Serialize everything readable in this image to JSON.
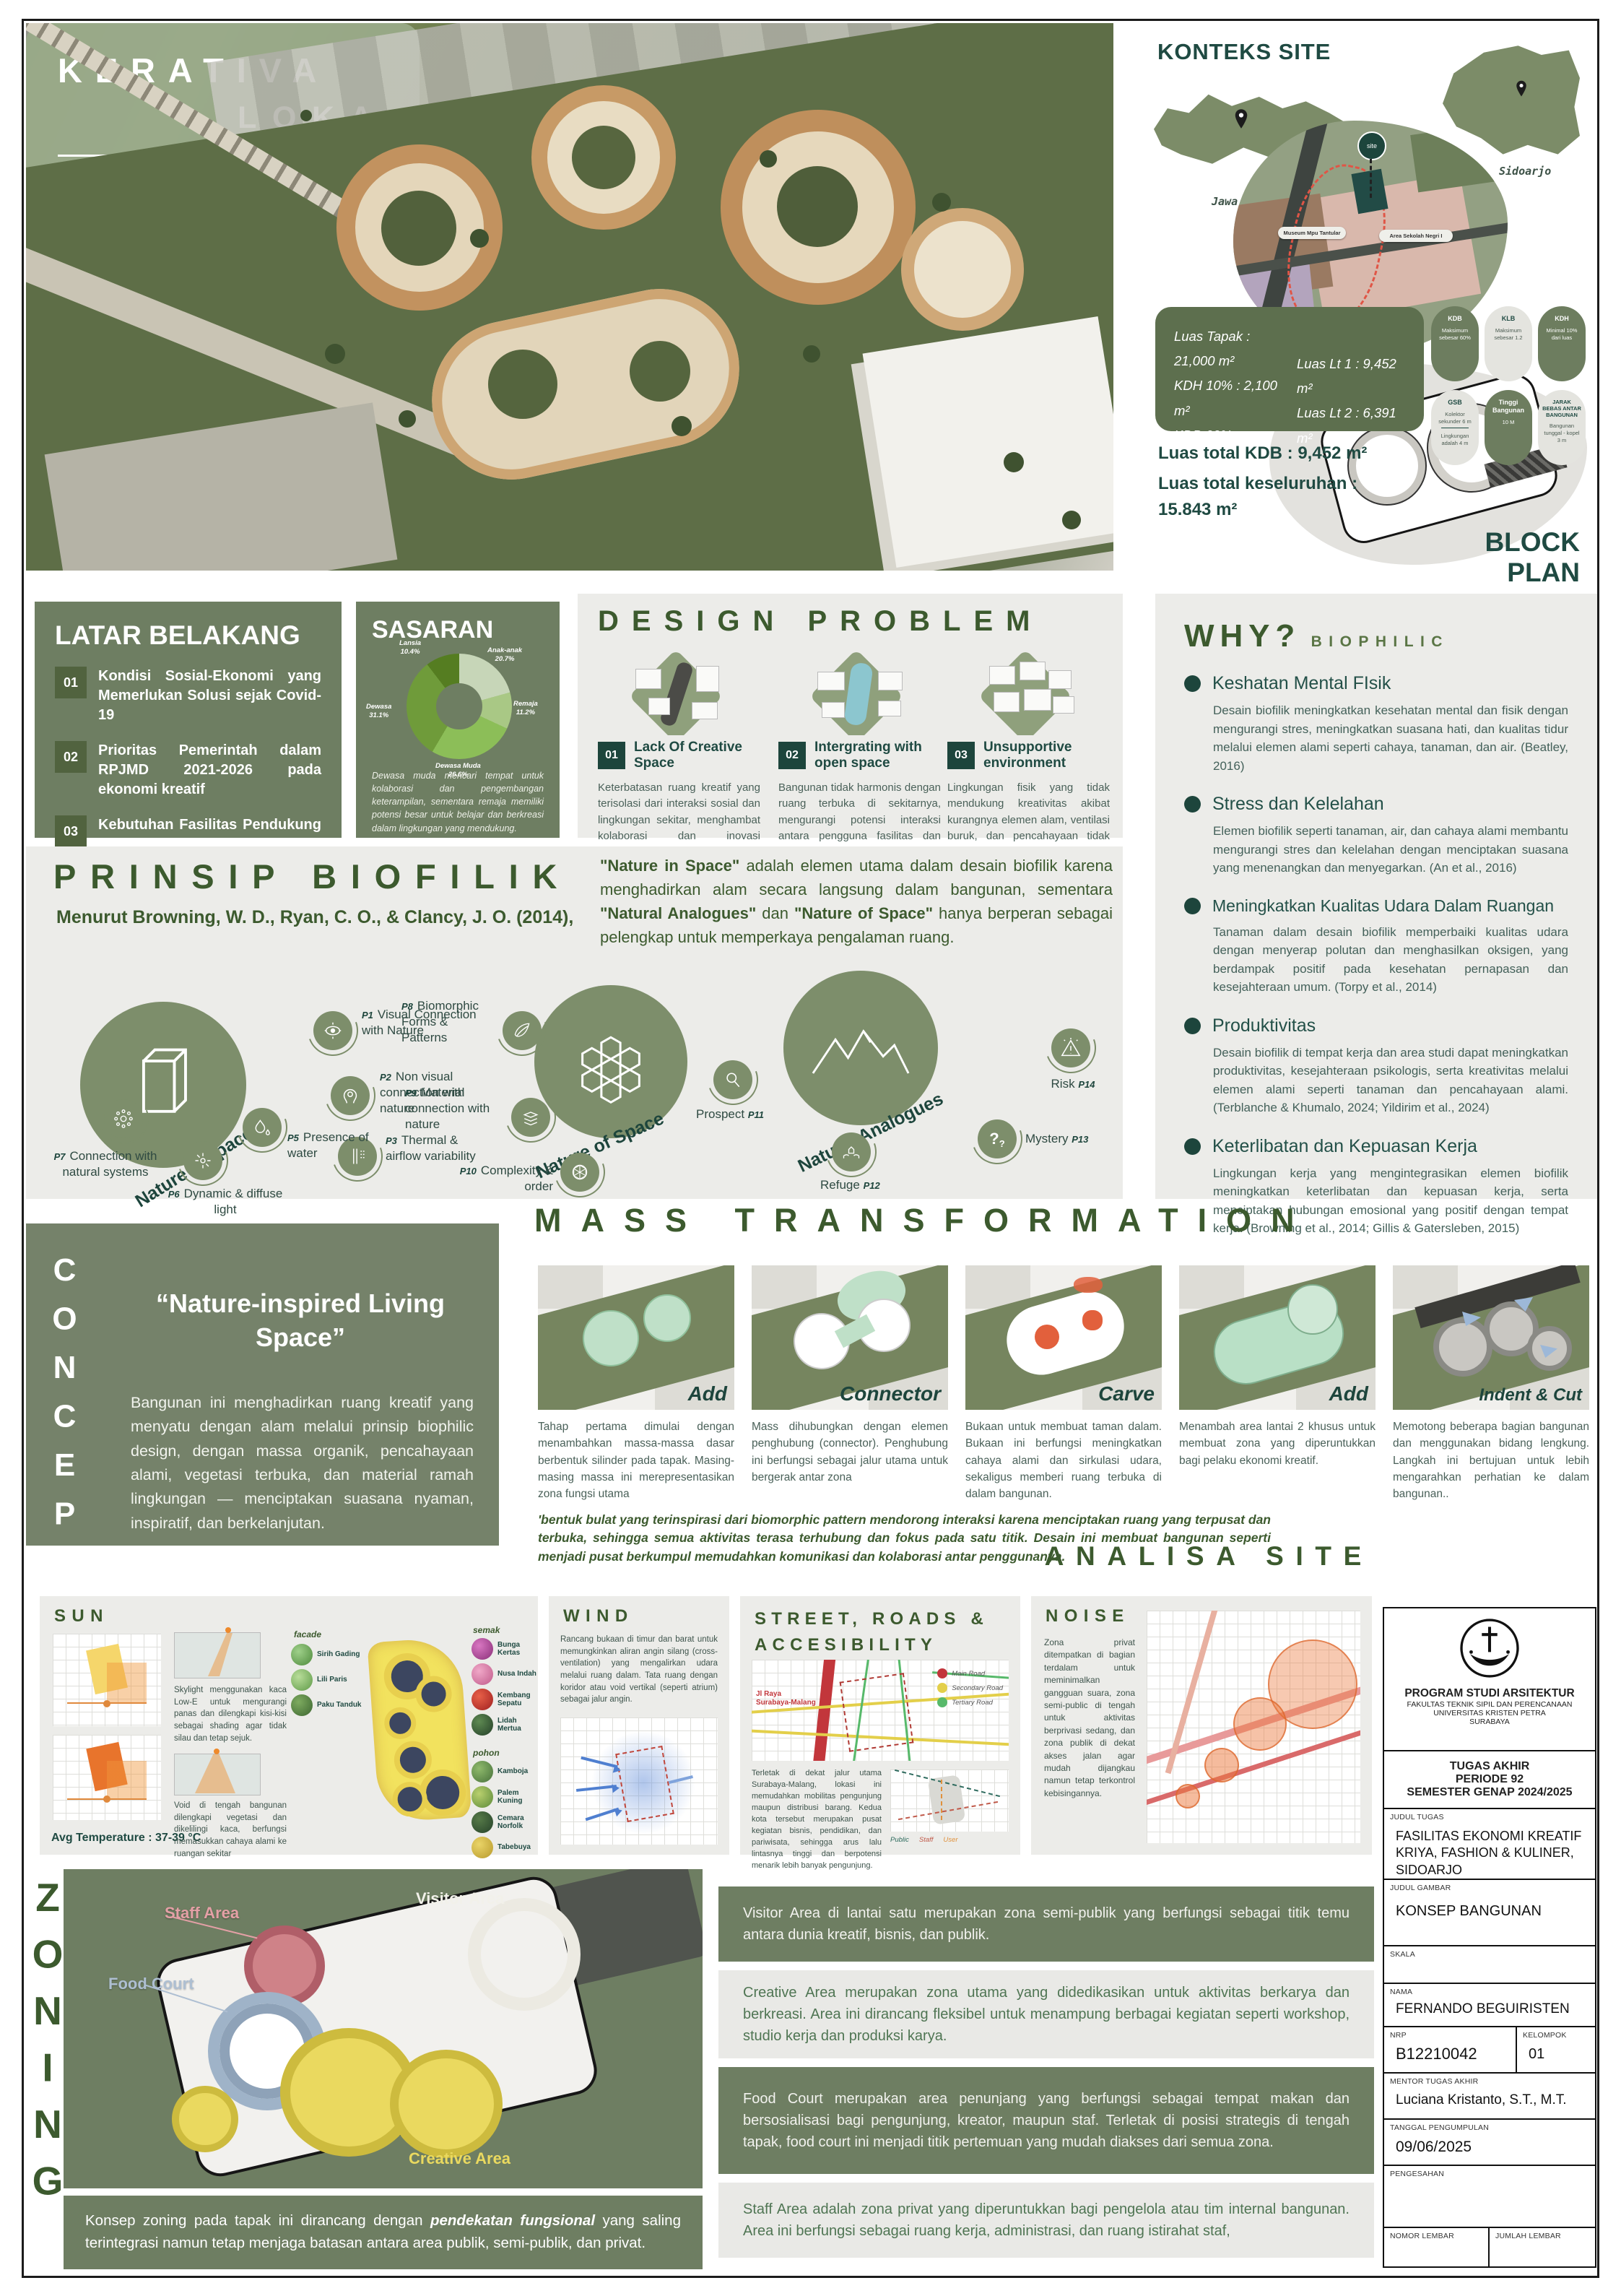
{
  "chart_data": {
    "type": "pie",
    "title": "SASARAN",
    "labels": [
      "Anak-anak",
      "Remaja",
      "Dewasa Muda",
      "Dewasa",
      "Lansia"
    ],
    "values": [
      20.7,
      11.2,
      26.6,
      31.1,
      10.4
    ],
    "colors": [
      "#c7d6b8",
      "#a9c885",
      "#8cbe58",
      "#6f9b3a",
      "#557d21"
    ],
    "legend_position": "around-donut"
  },
  "hero": {
    "title_line1": "KERATIVA",
    "title_line2": "LOKA",
    "sub_left1": "FASILITAS",
    "sub_right1": "EKONOMI",
    "sub_left2": "KREATIF",
    "sub_det1": "KRIYA, FASHION &",
    "sub_det2": "KULINER,",
    "sub_det3": "SIDOARJO"
  },
  "konteks": {
    "title": "KONTEKS SITE",
    "map_jatim_label": "Jawa Timur",
    "map_sidoarjo_label": "Sidoarjo",
    "pin_site": "site",
    "pin_museum": "Museum Mpu Tantular",
    "pin_school": "Area Sekolah Negri I",
    "regulations": [
      {
        "code": "KDB",
        "line1": "Maksimum sebesar 60%"
      },
      {
        "code": "KLB",
        "line1": "Maksimum sebesar 1.2"
      },
      {
        "code": "KDH",
        "line1": "Minimal 10% dari luas"
      },
      {
        "code": "GSB",
        "line1": "Kolektor sekunder 6 m",
        "line2": "Lingkungan adalah 4 m"
      },
      {
        "code": "Tinggi Bangunan",
        "line1": "10 M"
      },
      {
        "code": "JARAK BEBAS ANTAR BANGUNAN",
        "line1": "Bangunan tunggal - kopel 3 m"
      }
    ],
    "stats_left": [
      "Luas Tapak : 21,000 m²",
      "KDH 10% : 2,100 m²",
      "KDB 60%  : 12,600 m²",
      "KLB maks 1,2  : 9,600 m²"
    ],
    "stats_right": [
      "Luas Lt 1 : 9,452 m²",
      "Luas Lt 2 : 6,391 m²"
    ],
    "total_kdb": "Luas total KDB : 9,452 m²",
    "total_line1": "Luas total keseluruhan :",
    "total_line2": "15.843 m²",
    "block_plan_label": "BLOCK PLAN"
  },
  "latar": {
    "title": "LATAR BELAKANG",
    "items": [
      {
        "num": "01",
        "text": "Kondisi Sosial-Ekonomi yang Memerlukan Solusi sejak Covid-19"
      },
      {
        "num": "02",
        "text": "Prioritas Pemerintah dalam RPJMD 2021-2026 pada ekonomi kreatif"
      },
      {
        "num": "03",
        "text": "Kebutuhan Fasilitas Pendukung Ekonomi Kreatif"
      }
    ]
  },
  "sasaran": {
    "title": "SASARAN",
    "segments": [
      {
        "label": "Anak-anak",
        "pct": "20.7%"
      },
      {
        "label": "Remaja",
        "pct": "11.2%"
      },
      {
        "label": "Dewasa Muda",
        "pct": "26.6%"
      },
      {
        "label": "Dewasa",
        "pct": "31.1%"
      },
      {
        "label": "Lansia",
        "pct": "10.4%"
      }
    ],
    "note": "Dewasa muda mencari tempat untuk kolaborasi dan pengembangan keterampilan, sementara remaja memiliki potensi besar untuk belajar dan berkreasi dalam lingkungan yang mendukung."
  },
  "design": {
    "title": "DESIGN PROBLEM",
    "items": [
      {
        "num": "01",
        "name": "Lack Of Creative Space",
        "desc": "Keterbatasan ruang kreatif yang terisolasi dari interaksi sosial dan lingkungan sekitar, menghambat kolaborasi dan inovasi antarpelaku industri kreatif"
      },
      {
        "num": "02",
        "name": "Intergrating with open space",
        "desc": "Bangunan tidak harmonis dengan ruang terbuka di sekitarnya, mengurangi potensi interaksi antara pengguna fasilitas dan alam/masyarakat."
      },
      {
        "num": "03",
        "name": "Unsupportive environment",
        "desc": "Lingkungan fisik yang tidak mendukung kreativitas akibat kurangnya elemen alam, ventilasi buruk, dan pencahayaan tidak optimal."
      }
    ]
  },
  "why": {
    "title": "WHY?",
    "subtitle": "BIOPHILIC",
    "items": [
      {
        "name": "Keshatan Mental FIsik",
        "desc": "Desain biofilik meningkatkan kesehatan mental dan fisik dengan mengurangi stres, meningkatkan suasana hati, dan kualitas tidur melalui elemen alami seperti cahaya, tanaman, dan air. (Beatley, 2016)"
      },
      {
        "name": "Stress dan Kelelahan",
        "desc": "Elemen biofilik seperti tanaman, air, dan cahaya alami membantu mengurangi stres dan kelelahan dengan menciptakan suasana yang menenangkan dan menyegarkan. (An et al., 2016)"
      },
      {
        "name": "Meningkatkan Kualitas Udara Dalam Ruangan",
        "desc": "Tanaman dalam desain biofilik memperbaiki kualitas udara dengan menyerap polutan dan menghasilkan oksigen, yang berdampak positif pada kesehatan pernapasan dan kesejahteraan umum. (Torpy et al., 2014)"
      },
      {
        "name": "Produktivitas",
        "desc": "Desain biofilik di tempat kerja dan area studi dapat meningkatkan produktivitas, kesejahteraan psikologis, serta kreativitas melalui elemen alami seperti tanaman dan pencahayaan alami. (Terblanche & Khumalo, 2024; Yildirim et al., 2024)"
      },
      {
        "name": "Keterlibatan dan Kepuasan Kerja",
        "desc": "Lingkungan kerja yang mengintegrasikan elemen biofilik meningkatkan keterlibatan dan kepuasan kerja, serta menciptakan hubungan emosional yang positif dengan tempat kerja. (Browning et al., 2014; Gillis & Gatersleben, 2015)"
      }
    ]
  },
  "prinsip": {
    "title": "PRINSIP BIOFILIK",
    "subtitle": "Menurut Browning, W. D., Ryan, C. O., & Clancy, J. O. (2014),",
    "intro": {
      "b1": "\"Nature in Space\"",
      "t1": " adalah elemen utama dalam desain biofilik karena menghadirkan alam secara langsung dalam bangunan, sementara ",
      "b2": "\"Natural Analogues\"",
      "t2": " dan ",
      "b3": "\"Nature of Space\"",
      "t3": " hanya berperan sebagai pelengkap untuk memperkaya pengalaman ruang."
    },
    "cluster1": {
      "name": "Nature in space",
      "items": [
        {
          "code": "P1",
          "label": "Visual Connection with Nature"
        },
        {
          "code": "P2",
          "label": "Non visual connection with nature"
        },
        {
          "code": "P3",
          "label": "Thermal & airflow variability"
        },
        {
          "code": "P5",
          "label": "Presence of water"
        },
        {
          "code": "P6",
          "label": "Dynamic & diffuse light"
        },
        {
          "code": "P7",
          "label": "Connection with natural systems"
        }
      ]
    },
    "cluster2": {
      "name": "Nature of Space",
      "items": [
        {
          "code": "P8",
          "label": "Biomorphic Forms & Patterns"
        },
        {
          "code": "P9",
          "label": "Material connection with nature"
        },
        {
          "code": "P10",
          "label": "Complexity & order"
        }
      ]
    },
    "cluster3": {
      "name": "Natural Analogues",
      "items": [
        {
          "code": "P11",
          "label": "Prospect"
        },
        {
          "code": "P12",
          "label": "Refuge"
        },
        {
          "code": "P13",
          "label": "Mystery"
        },
        {
          "code": "P14",
          "label": "Risk"
        }
      ]
    }
  },
  "concept": {
    "vertical": "CONCEPT",
    "quote": "“Nature-inspired Living Space”",
    "body": "Bangunan ini menghadirkan ruang kreatif yang menyatu dengan alam melalui prinsip biophilic design, dengan massa organik, pencahayaan alami, vegetasi terbuka, dan material ramah lingkungan — menciptakan suasana nyaman, inspiratif, dan berkelanjutan."
  },
  "mass": {
    "title": "MASS TRANSFORMATION",
    "steps": [
      {
        "name": "Add",
        "desc": "Tahap pertama dimulai dengan menambahkan massa-massa dasar berbentuk silinder pada tapak. Masing-masing massa ini merepresentasikan zona fungsi utama"
      },
      {
        "name": "Connector",
        "desc": "Mass dihubungkan dengan elemen penghubung (connector). Penghubung ini berfungsi sebagai jalur utama untuk bergerak antar zona"
      },
      {
        "name": "Carve",
        "desc": "Bukaan untuk membuat taman dalam. Bukaan ini berfungsi meningkatkan cahaya alami dan sirkulasi udara, sekaligus memberi ruang terbuka di dalam bangunan."
      },
      {
        "name": "Add",
        "desc": "Menambah area lantai 2 khusus untuk membuat zona yang diperuntukkan bagi pelaku ekonomi kreatif."
      },
      {
        "name": "Indent & Cut",
        "desc": "Memotong beberapa bagian bangunan dan menggunakan bidang lengkung. Langkah ini bertujuan untuk lebih mengarahkan perhatian ke dalam bangunan.."
      }
    ],
    "footnote": "'bentuk bulat yang terinspirasi dari biomorphic pattern mendorong interaksi karena menciptakan ruang yang terpusat dan terbuka, sehingga semua aktivitas terasa terhubung dan fokus pada satu titik. Desain ini membuat bangunan seperti menjadi pusat berkumpul memudahkan komunikasi dan kolaborasi antar penggunanya."
  },
  "analisa": {
    "header": "ANALISA SITE",
    "sun": {
      "title": "SUN",
      "skylight_text": "Skylight menggunakan kaca Low-E untuk mengurangi panas dan dilengkapi kisi-kisi sebagai shading agar tidak silau dan tetap sejuk.",
      "void_text": "Void di tengah bangunan dilengkapi vegetasi dan dikelilingi kaca, berfungsi memasukkan cahaya alami ke ruangan sekitar",
      "avg_temp": "Avg Temperature : 37-39 °C",
      "group_facade": "facade",
      "group_semak": "semak",
      "group_pohon": "pohon",
      "plants_facade": [
        "Sirih Gading",
        "Lili Paris",
        "Paku Tanduk"
      ],
      "plants_semak": [
        "Bunga Kertas",
        "Nusa Indah",
        "Kembang Sepatu",
        "Lidah Mertua"
      ],
      "plants_pohon": [
        "Kamboja",
        "Palem Kuning",
        "Cemara Norfolk",
        "Tabebuya"
      ]
    },
    "wind": {
      "title": "WIND",
      "text": "Rancang bukaan di timur dan barat untuk memungkinkan aliran angin silang (cross-ventilation) yang mengalirkan udara melalui ruang dalam. Tata ruang dengan koridor atau void vertikal (seperti atrium) sebagai jalur angin."
    },
    "street": {
      "title": "STREET, ROADS & ACCESIBILITY",
      "road_label": "Jl Raya Surabaya-Malang",
      "legend": [
        "Main Road",
        "Secondary Road",
        "Tertiary Road"
      ],
      "text": "Terletak di dekat jalur utama Surabaya-Malang, lokasi ini memudahkan mobilitas pengunjung maupun distribusi barang. Kedua kota tersebut merupakan pusat kegiatan bisnis, pendidikan, dan pariwisata, sehingga arus lalu lintasnya tinggi dan berpotensi menarik lebih banyak pengunjung.",
      "legend2": [
        "Public",
        "Staff",
        "User"
      ]
    },
    "noise": {
      "title": "NOISE",
      "text": "Zona privat ditempatkan di bagian terdalam untuk meminimalkan gangguan suara, zona semi-public di tengah untuk aktivitas berprivasi sedang, dan zona publik di dekat akses jalan agar mudah dijangkau namun tetap terkontrol kebisingannya."
    }
  },
  "zoning": {
    "vertical": "ZONING",
    "label_staff": "Staff Area",
    "label_visitor": "Visitor Area",
    "label_foodcourt": "Food Court",
    "label_creative": "Creative Area",
    "rows": [
      {
        "text": "Visitor Area di lantai satu merupakan zona semi-publik yang berfungsi sebagai titik temu antara dunia kreatif, bisnis, dan publik."
      },
      {
        "text": "Creative Area merupakan zona utama yang didedikasikan untuk aktivitas berkarya dan berkreasi. Area ini dirancang fleksibel untuk menampung berbagai kegiatan seperti workshop, studio kerja dan produksi karya."
      },
      {
        "text": "Food Court merupakan area penunjang yang berfungsi sebagai tempat makan dan bersosialisasi bagi pengunjung, kreator, maupun staf. Terletak di posisi strategis di tengah tapak, food court ini menjadi titik pertemuan yang mudah diakses dari semua zona."
      },
      {
        "text": "Staff Area adalah zona privat yang diperuntukkan bagi pengelola atau tim internal bangunan. Area ini berfungsi sebagai ruang kerja, administrasi, dan ruang istirahat staf,"
      }
    ],
    "concept_pre": "Konsep zoning pada tapak ini dirancang dengan ",
    "concept_bold": "pendekatan fungsional",
    "concept_post": " yang saling terintegrasi namun tetap menjaga batasan antara area publik, semi-publik, dan privat."
  },
  "titleblock": {
    "program": "PROGRAM STUDI ARSITEKTUR",
    "faculty": "FAKULTAS TEKNIK SIPIL DAN PERENCANAAN",
    "university": "UNIVERSITAS KRISTEN PETRA",
    "city": "SURABAYA",
    "task1": "TUGAS AKHIR",
    "task2": "PERIODE 92",
    "task3": "SEMESTER GENAP 2024/2025",
    "judul_tugas_label": "JUDUL TUGAS",
    "judul_tugas": "FASILITAS EKONOMI KREATIF KRIYA, FASHION & KULINER, SIDOARJO",
    "judul_gambar_label": "JUDUL GAMBAR",
    "judul_gambar": "KONSEP BANGUNAN",
    "skala_label": "SKALA",
    "nama_label": "NAMA",
    "nama": "FERNANDO BEGUIRISTEN",
    "nrp_label": "NRP",
    "nrp": "B12210042",
    "kelompok_label": "KELOMPOK",
    "kelompok": "01",
    "mentor_label": "MENTOR TUGAS AKHIR",
    "mentor": "Luciana Kristanto, S.T., M.T.",
    "tanggal_label": "TANGGAL PENGUMPULAN",
    "tanggal": "09/06/2025",
    "pengesahan_label": "PENGESAHAN",
    "nomor_label": "NOMOR LEMBAR",
    "jumlah_label": "JUMLAH LEMBAR"
  },
  "icons": {
    "mystery": "?",
    "risk": "!"
  }
}
